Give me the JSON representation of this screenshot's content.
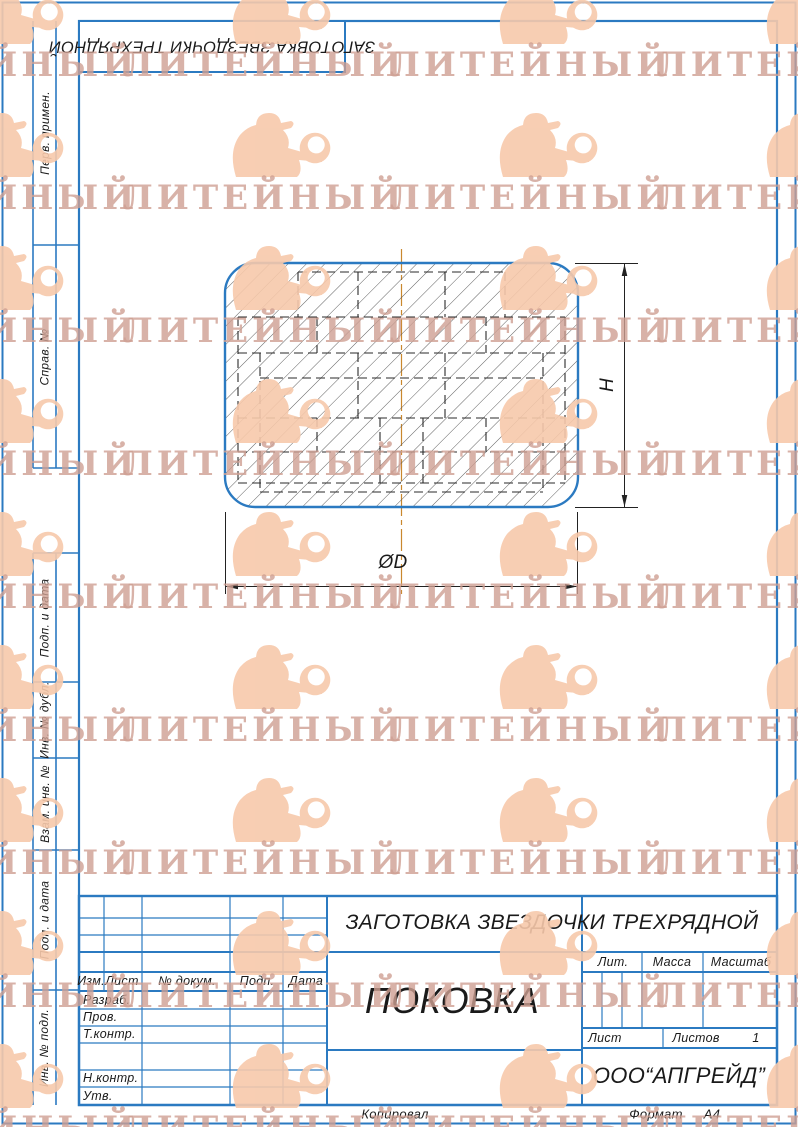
{
  "watermark": {
    "text": "ЛИТЕЙНЫЙ"
  },
  "stamp_top": {
    "text": "ЗАГОТОВКА ЗВЕЗДОЧКИ ТРЕХРЯДНОЙ"
  },
  "sidebar": {
    "labels": [
      "Перв. примен.",
      "Справ. №",
      "Подп. и дата",
      "Инв. № дубл.",
      "Взам. инв. №",
      "Подп. и дата",
      "Инв. № подл."
    ]
  },
  "drawing": {
    "dim_height_label": "H",
    "dim_diameter_label": "ØD"
  },
  "title_block": {
    "header_cols": [
      "Изм.",
      "Лист",
      "№ докум.",
      "Подп.",
      "Дата"
    ],
    "sig_labels": [
      "Разраб.",
      "Пров.",
      "Т.контр.",
      "Н.контр.",
      "Утв."
    ],
    "doc_title": "ЗАГОТОВКА ЗВЕЗДОЧКИ ТРЕХРЯДНОЙ",
    "part_name": "ПОКОВКА",
    "lit_label": "Лит.",
    "mass_label": "Масса",
    "scale_label": "Масштаб",
    "sheet_label": "Лист",
    "sheets_label": "Листов",
    "sheets_value": "1",
    "company": "ООО“АПГРЕЙД”",
    "copied_label": "Копировал",
    "format_label": "Формат",
    "format_value": "A4"
  },
  "colors": {
    "frame_blue": "#2b7ac1",
    "centerline_orange": "#c9882e",
    "hatch_gray": "#4f4f4f",
    "watermark_figure": "#f7c9ab",
    "watermark_text": "#cfa093"
  }
}
